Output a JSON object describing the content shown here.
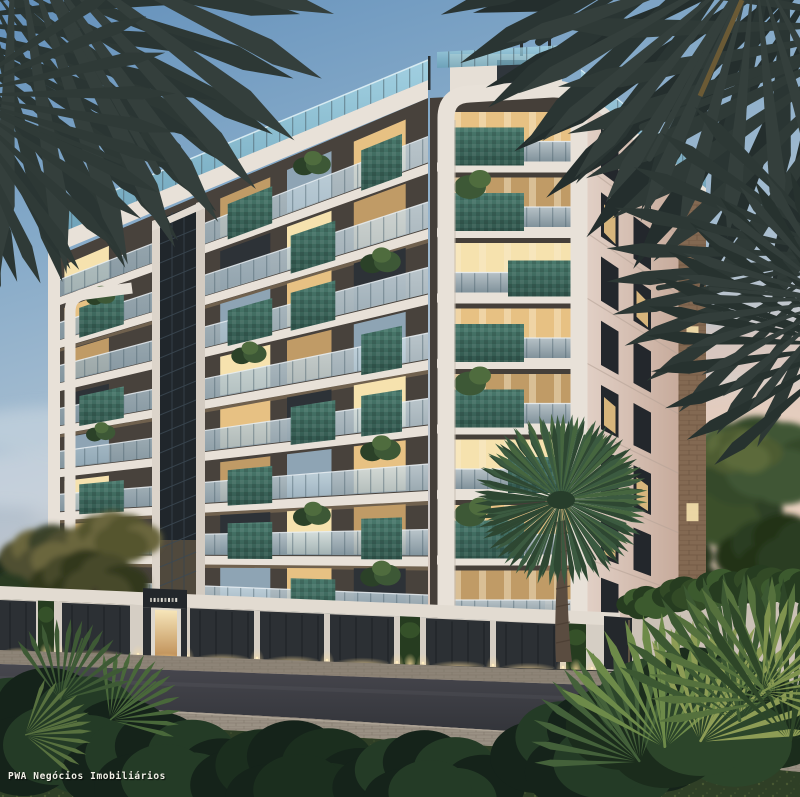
{
  "watermark": {
    "text": "PWA Negócios Imobiliários"
  },
  "scene": {
    "description": "Dusk architectural rendering of a modern 8-story apartment building with curved white balcony bands, teal mosaic planter boxes, rooftop glass railing, lit interiors, street-level garages, palm trees and dense foreground foliage",
    "time_of_day": "dusk",
    "floors": 8,
    "colors": {
      "facade_backdrop": "#48423c",
      "slab_white": "#e8e1d8",
      "slab_shadow": "#c7bcb0",
      "window_warm": "#e7c183",
      "window_warm_bright": "#f6e2ae",
      "window_warm_dim": "#c09b66",
      "window_cool": "#8ea4b4",
      "window_dark": "#2d3237",
      "garage_door": "#2c3034",
      "door_panel_line": "#1e2226",
      "balcony_tree": "#3d5836",
      "balcony_tree_dark": "#2b4128",
      "balcony_tree_light": "#4f6c3e",
      "brick": "#836952",
      "hedge": "#263c20",
      "hedge_light": "#3c5a2e",
      "wall": "#cbc1b6",
      "palm_dark": "#2d3835",
      "palm_green": "#3b5a40",
      "palm_green_dark": "#2e4732",
      "trunk": "#5a4c40",
      "foliage_dark": "#15231a",
      "foliage_mid": "#243b26",
      "foliage_light": "#49683a",
      "leaf_yellow": "#8d9c55",
      "core_glass": "#20262b",
      "core_frame": "#dcd4ca"
    }
  }
}
